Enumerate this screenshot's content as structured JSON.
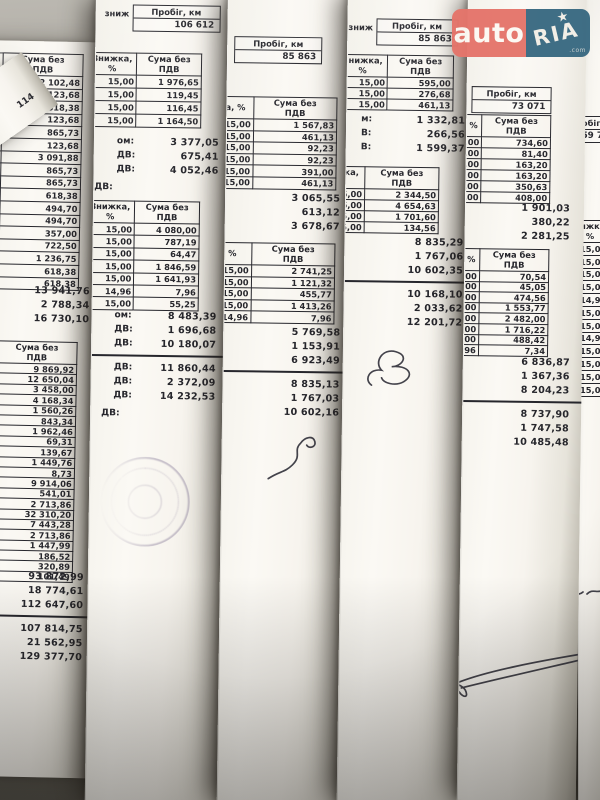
{
  "watermark": {
    "auto": "auto",
    "ria": "RIA",
    "star": "★",
    "com": ".com"
  },
  "colors": {
    "logo_red": "#e5756b",
    "logo_blue": "#3a6a82",
    "paper": "#f8f6f0",
    "ink": "#26262c",
    "stamp": "#7a6d8f",
    "background": "#6b6860"
  },
  "labels": {
    "discount": "Знижка, %",
    "sum": "Сума без\nПДВ",
    "mileage": "Пробіг, км"
  },
  "sheets": [
    {
      "name": "a",
      "x": -16,
      "y": 40,
      "w": 130,
      "h": 736,
      "rot": 1.2,
      "z": 1,
      "blocks": [
        {
          "t": "table",
          "x": -28,
          "y": 12,
          "rh": 11.6,
          "dw": 46,
          "sw": 80,
          "disc_h": "Знижка, %",
          "sum_h": "Сума без\nПДВ",
          "rows": [
            [
              "15,00",
              "2 102,48"
            ],
            [
              "15,00",
              "123,68"
            ],
            [
              "15,00",
              "618,38"
            ],
            [
              "15,00",
              "123,68"
            ],
            [
              "15,00",
              "865,73"
            ],
            [
              "15,00",
              "123,68"
            ],
            [
              "15,00",
              "3 091,88"
            ],
            [
              "15,00",
              "865,73"
            ],
            [
              "15,00",
              "865,73"
            ],
            [
              "15,00",
              "618,38"
            ],
            [
              "15,00",
              "494,70"
            ],
            [
              "15,00",
              "494,70"
            ],
            [
              "15,00",
              "357,00"
            ],
            [
              "15,00",
              "722,50"
            ],
            [
              "15,00",
              "1 236,75"
            ],
            [
              "15,00",
              "618,38"
            ],
            [
              "15,00",
              "618,38"
            ]
          ]
        },
        {
          "t": "totals",
          "x": 6,
          "y": 242,
          "w": 104,
          "values": [
            "13 941,76",
            "2 788,34",
            "16 730,10"
          ]
        },
        {
          "t": "table",
          "x": -28,
          "y": 300,
          "rh": 9.4,
          "dw": 46,
          "sw": 80,
          "disc_h": "жка, %",
          "sum_h": "Сума без\nПДВ",
          "rows": [
            [
              "15,00",
              "9 869,92"
            ],
            [
              "15,00",
              "12 650,04"
            ],
            [
              "15,00",
              "3 458,00"
            ],
            [
              "15,00",
              "4 168,34"
            ],
            [
              "15,00",
              "1 560,26"
            ],
            [
              "15,00",
              "843,34"
            ],
            [
              "15,00",
              "1 962,46"
            ],
            [
              "15,00",
              "69,31"
            ],
            [
              "15,00",
              "139,67"
            ],
            [
              "15,00",
              "1 449,76"
            ],
            [
              "15,00",
              "8,73"
            ],
            [
              "15,00",
              "9 914,06"
            ],
            [
              "15,00",
              "541,01"
            ],
            [
              "15,00",
              "2 713,86"
            ],
            [
              "15,00",
              "32 310,20"
            ],
            [
              "15,00",
              "7 443,28"
            ],
            [
              "15,00",
              "2 713,86"
            ],
            [
              "15,00",
              "1 447,99"
            ],
            [
              "15,00",
              "186,52"
            ],
            [
              "15,00",
              "320,89"
            ],
            [
              "15,00",
              "101,49"
            ]
          ]
        },
        {
          "t": "totals",
          "x": 2,
          "y": 528,
          "w": 108,
          "values": [
            "93 872,99",
            "18 774,61",
            "112 647,60"
          ]
        },
        {
          "t": "rule",
          "x": -14,
          "y": 574,
          "w": 142
        },
        {
          "t": "totals",
          "x": 2,
          "y": 580,
          "w": 108,
          "values": [
            "107 814,75",
            "21 562,95",
            "129 377,70"
          ]
        }
      ]
    },
    {
      "name": "b",
      "x": 96,
      "y": -6,
      "w": 150,
      "h": 810,
      "rot": 0.8,
      "z": 2,
      "blocks": [
        {
          "t": "mileage",
          "x": 8,
          "y": 10,
          "frag": "зниж",
          "label": "Пробіг, км",
          "value": "106 612",
          "bw": 86
        },
        {
          "t": "table",
          "x": -44,
          "y": 58,
          "lw": 38,
          "lh": "В",
          "dw": 52,
          "sw": 78,
          "rh": 12,
          "disc_h": "Знижка, %",
          "sum_h": "Сума без\nПДВ",
          "left": [
            "70,00",
            "70,00",
            "70,00",
            "70,00"
          ],
          "rows": [
            [
              "15,00",
              "1 976,65"
            ],
            [
              "15,00",
              "119,45"
            ],
            [
              "15,00",
              "116,45"
            ],
            [
              "15,00",
              "1 164,50"
            ]
          ]
        },
        {
          "t": "totals",
          "x": 22,
          "y": 140,
          "w": 102,
          "labels": [
            "ом:",
            "ДВ:",
            "ДВ:"
          ],
          "values": [
            "3 377,05",
            "675,41",
            "4 052,46"
          ]
        },
        {
          "t": "frag",
          "x": 0,
          "y": 188,
          "text": "ДВ:",
          "fs": 9
        },
        {
          "t": "table",
          "x": -44,
          "y": 206,
          "lw": 38,
          "lh": "з",
          "dw": 52,
          "sw": 78,
          "rh": 11.4,
          "disc_h": "Знижка, %",
          "sum_h": "Сума без\nПДВ",
          "left": [
            "35,00",
            "36,11",
            "75,85",
            "19,52",
            "84,62",
            "9,36",
            "83,00"
          ],
          "rows": [
            [
              "15,00",
              "4 080,00"
            ],
            [
              "15,00",
              "787,19"
            ],
            [
              "15,00",
              "64,47"
            ],
            [
              "15,00",
              "1 846,59"
            ],
            [
              "15,00",
              "1 641,93"
            ],
            [
              "14,96",
              "7,96"
            ],
            [
              "15,00",
              "55,25"
            ]
          ]
        },
        {
          "t": "totals",
          "x": 22,
          "y": 314,
          "w": 102,
          "labels": [
            "ом:",
            "ДВ:",
            "ДВ:"
          ],
          "values": [
            "8 483,39",
            "1 696,68",
            "10 180,07"
          ]
        },
        {
          "t": "rule",
          "x": -8,
          "y": 360,
          "w": 140
        },
        {
          "t": "totals",
          "x": 22,
          "y": 366,
          "w": 102,
          "labels": [
            "ДВ:",
            "ДВ:",
            "ДВ:"
          ],
          "values": [
            "11 860,44",
            "2 372,09",
            "14 232,53"
          ]
        },
        {
          "t": "frag",
          "x": 10,
          "y": 414,
          "text": "ДВ:",
          "fs": 9
        },
        {
          "t": "stamp",
          "x": 10,
          "y": 462,
          "d": 86
        }
      ]
    },
    {
      "name": "c",
      "x": 228,
      "y": -8,
      "w": 140,
      "h": 812,
      "rot": 0.8,
      "z": 3,
      "blocks": [
        {
          "t": "mileage",
          "x": 6,
          "y": 44,
          "label": "Пробіг, км",
          "value": "85 863",
          "bw": 86
        },
        {
          "t": "table",
          "x": -30,
          "y": 104,
          "dw": 56,
          "sw": 84,
          "rh": 10.6,
          "disc_h": "ижка, %",
          "sum_h": "Сума без\nПДВ",
          "rows": [
            [
              "15,00",
              "1 567,83"
            ],
            [
              "15,00",
              "461,13"
            ],
            [
              "15,00",
              "92,23"
            ],
            [
              "15,00",
              "92,23"
            ],
            [
              "15,00",
              "391,00"
            ],
            [
              "15,00",
              "461,13"
            ]
          ]
        },
        {
          "t": "totals",
          "x": 8,
          "y": 198,
          "w": 106,
          "values": [
            "3 065,55",
            "613,12",
            "3 678,67"
          ]
        },
        {
          "t": "table",
          "x": -30,
          "y": 250,
          "dw": 56,
          "sw": 84,
          "rh": 10.6,
          "disc_h": "ка, %",
          "sum_h": "Сума без\nПДВ",
          "rows": [
            [
              "15,00",
              "2 741,25"
            ],
            [
              "15,00",
              "1 121,32"
            ],
            [
              "15,00",
              "455,77"
            ],
            [
              "15,00",
              "1 413,26"
            ],
            [
              "14,96",
              "7,96"
            ]
          ]
        },
        {
          "t": "totals",
          "x": 8,
          "y": 332,
          "w": 108,
          "values": [
            "5 769,58",
            "1 153,91",
            "6 923,49"
          ]
        },
        {
          "t": "rule",
          "x": -10,
          "y": 378,
          "w": 148
        },
        {
          "t": "totals",
          "x": 8,
          "y": 384,
          "w": 108,
          "values": [
            "8 835,13",
            "1 767,03",
            "10 602,16"
          ]
        },
        {
          "t": "sig",
          "x": 40,
          "y": 432,
          "w": 72,
          "h": 60,
          "path": "curve"
        }
      ]
    },
    {
      "name": "d",
      "x": 348,
      "y": -12,
      "w": 140,
      "h": 816,
      "rot": 0.8,
      "z": 4,
      "blocks": [
        {
          "t": "mileage",
          "x": 0,
          "y": 30,
          "frag": "зниж",
          "label": "Пробіг, км",
          "value": "85 863",
          "bw": 80
        },
        {
          "t": "table",
          "x": -34,
          "y": 66,
          "lw": 24,
          "lh": "",
          "dw": 52,
          "sw": 74,
          "rh": 10,
          "disc_h": "Знижка, %",
          "sum_h": "Сума без\nПДВ",
          "left": [
            ",00",
            ",03",
            ",01"
          ],
          "rows": [
            [
              "15,00",
              "595,00"
            ],
            [
              "15,00",
              "276,68"
            ],
            [
              "15,00",
              "461,13"
            ]
          ]
        },
        {
          "t": "totals",
          "x": 14,
          "y": 124,
          "w": 104,
          "labels": [
            "м:",
            "В:",
            "В:"
          ],
          "values": [
            "1 332,81",
            "266,56",
            "1 599,37"
          ]
        },
        {
          "t": "table",
          "x": -34,
          "y": 178,
          "dw": 52,
          "sw": 74,
          "rh": 10,
          "disc_h": "Знижка, %",
          "sum_h": "Сума без\nПДВ",
          "rows": [
            [
              "15,00",
              "2 344,50"
            ],
            [
              "15,00",
              "4 654,63"
            ],
            [
              "15,00",
              "1 701,60"
            ],
            [
              "15,00",
              "134,56"
            ]
          ]
        },
        {
          "t": "totals",
          "x": 14,
          "y": 246,
          "w": 104,
          "values": [
            "8 835,29",
            "1 767,06",
            "10 602,35"
          ]
        },
        {
          "t": "rule",
          "x": -8,
          "y": 292,
          "w": 144
        },
        {
          "t": "totals",
          "x": 14,
          "y": 298,
          "w": 104,
          "values": [
            "10 168,10",
            "2 033,62",
            "12 201,72"
          ]
        },
        {
          "t": "sig",
          "x": 14,
          "y": 348,
          "w": 64,
          "h": 60,
          "path": "b"
        }
      ]
    },
    {
      "name": "e",
      "x": 468,
      "y": -6,
      "w": 118,
      "h": 806,
      "rot": 0.8,
      "z": 6,
      "blocks": [
        {
          "t": "mileage",
          "x": 4,
          "y": 92,
          "label": "Пробіг, км",
          "value": "73 071",
          "bw": 78
        },
        {
          "t": "table",
          "x": -34,
          "y": 120,
          "dw": 52,
          "sw": 76,
          "rh": 10,
          "disc_h": "ижка, %",
          "sum_h": "Сума без\nПДВ",
          "rows": [
            [
              "15,00",
              "734,60"
            ],
            [
              "15,00",
              "81,40"
            ],
            [
              "15,00",
              "163,20"
            ],
            [
              "15,00",
              "163,20"
            ],
            [
              "15,00",
              "350,63"
            ],
            [
              "15,00",
              "408,00"
            ]
          ]
        },
        {
          "t": "totals",
          "x": 2,
          "y": 206,
          "w": 102,
          "values": [
            "1 901,03",
            "380,22",
            "2 281,25"
          ]
        },
        {
          "t": "table",
          "x": -34,
          "y": 254,
          "dw": 52,
          "sw": 76,
          "rh": 9.6,
          "disc_h": "ижка, %",
          "sum_h": "Сума без\nПДВ",
          "rows": [
            [
              "15,00",
              "70,54"
            ],
            [
              "15,00",
              "45,05"
            ],
            [
              "15,00",
              "474,56"
            ],
            [
              "15,00",
              "1 553,77"
            ],
            [
              "15,00",
              "2 482,00"
            ],
            [
              "15,00",
              "1 716,22"
            ],
            [
              "15,00",
              "488,42"
            ],
            [
              "14,96",
              "7,34"
            ]
          ]
        },
        {
          "t": "totals",
          "x": 2,
          "y": 360,
          "w": 104,
          "values": [
            "6 836,87",
            "1 367,36",
            "8 204,23"
          ]
        },
        {
          "t": "rule",
          "x": -8,
          "y": 406,
          "w": 132
        },
        {
          "t": "totals",
          "x": 2,
          "y": 412,
          "w": 104,
          "values": [
            "8 737,90",
            "1 747,58",
            "10 485,48"
          ]
        },
        {
          "t": "sig",
          "x": -10,
          "y": 646,
          "w": 140,
          "h": 60,
          "path": "sweep"
        }
      ]
    },
    {
      "name": "f",
      "x": 578,
      "y": -2,
      "w": 40,
      "h": 804,
      "rot": 0,
      "z": 5,
      "blocks": [
        {
          "t": "mileage",
          "x": -16,
          "y": 118,
          "label": "Пробіг, км",
          "value": "59 7",
          "bw": 44
        },
        {
          "t": "coltable",
          "x": -2,
          "y": 222,
          "w": 26,
          "rh": 11.8,
          "header": "ижка, %",
          "values": [
            "15,00",
            "15,00",
            "15,00",
            "15,00",
            "14,95",
            "15,00",
            "15,00",
            "14,96",
            "15,00",
            "15,00",
            "15,00",
            "15,00"
          ]
        },
        {
          "t": "sig",
          "x": -12,
          "y": 580,
          "w": 52,
          "h": 30,
          "path": "scribble"
        }
      ]
    },
    {
      "name": "corner",
      "x": -40,
      "y": 95,
      "w": 74,
      "h": 64,
      "rot": -35,
      "z": 8,
      "blocks": [
        {
          "t": "frag",
          "x": 40,
          "y": 38,
          "text": "114",
          "fs": 9
        }
      ]
    }
  ]
}
